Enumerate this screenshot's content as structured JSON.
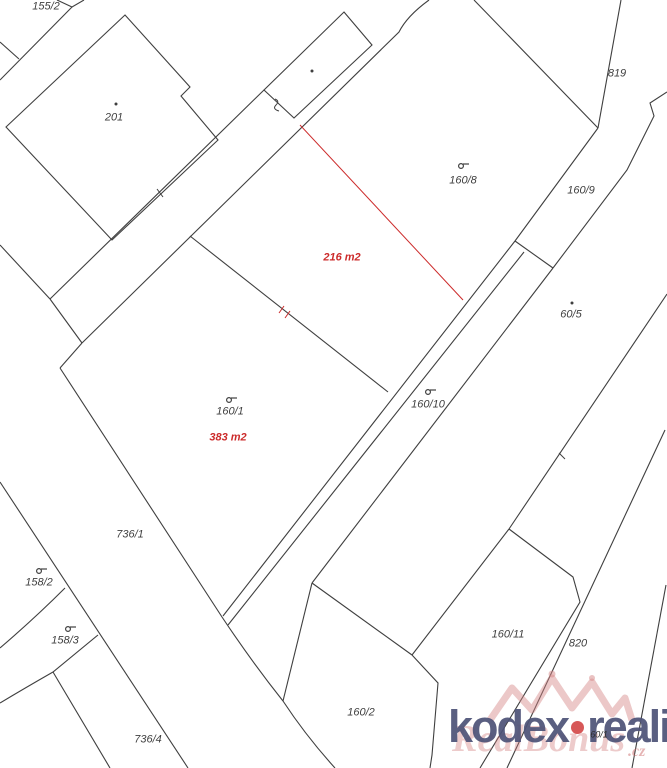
{
  "map": {
    "background": "#ffffff",
    "line_color": "#3f3f3f",
    "red_color": "#cc2b2b",
    "parcel_labels": [
      {
        "text": "155/2",
        "x": 46,
        "y": 7
      },
      {
        "text": "201",
        "x": 114,
        "y": 118
      },
      {
        "text": "819",
        "x": 617,
        "y": 74
      },
      {
        "text": "160/8",
        "x": 463,
        "y": 181
      },
      {
        "text": "160/9",
        "x": 581,
        "y": 191
      },
      {
        "text": "60/5",
        "x": 571,
        "y": 315
      },
      {
        "text": "160/1",
        "x": 230,
        "y": 412
      },
      {
        "text": "160/10",
        "x": 428,
        "y": 405
      },
      {
        "text": "736/1",
        "x": 130,
        "y": 535
      },
      {
        "text": "158/2",
        "x": 39,
        "y": 583
      },
      {
        "text": "158/3",
        "x": 65,
        "y": 641
      },
      {
        "text": "736/4",
        "x": 148,
        "y": 740
      },
      {
        "text": "160/2",
        "x": 361,
        "y": 713
      },
      {
        "text": "160/11",
        "x": 508,
        "y": 635
      },
      {
        "text": "820",
        "x": 578,
        "y": 644
      }
    ],
    "area_labels": [
      {
        "text": "216 m2",
        "x": 342,
        "y": 258
      },
      {
        "text": "383 m2",
        "x": 228,
        "y": 438
      }
    ],
    "tiny_label": {
      "text": "60/1",
      "x": 599,
      "y": 735
    },
    "land_use_symbols": [
      {
        "x": 461,
        "y": 166
      },
      {
        "x": 229,
        "y": 400
      },
      {
        "x": 428,
        "y": 392
      },
      {
        "x": 39,
        "y": 571
      },
      {
        "x": 68,
        "y": 629
      }
    ],
    "building_dots": [
      {
        "x": 116,
        "y": 104
      },
      {
        "x": 312,
        "y": 71
      },
      {
        "x": 572,
        "y": 303
      }
    ]
  },
  "watermark": {
    "brand_left": "kodex",
    "separator": "•",
    "brand_right": "reality",
    "overlay_text": "RealBonus",
    "overlay_suffix": ".cz",
    "brand_color": "#4e5378",
    "overlay_color": "#d07878"
  }
}
